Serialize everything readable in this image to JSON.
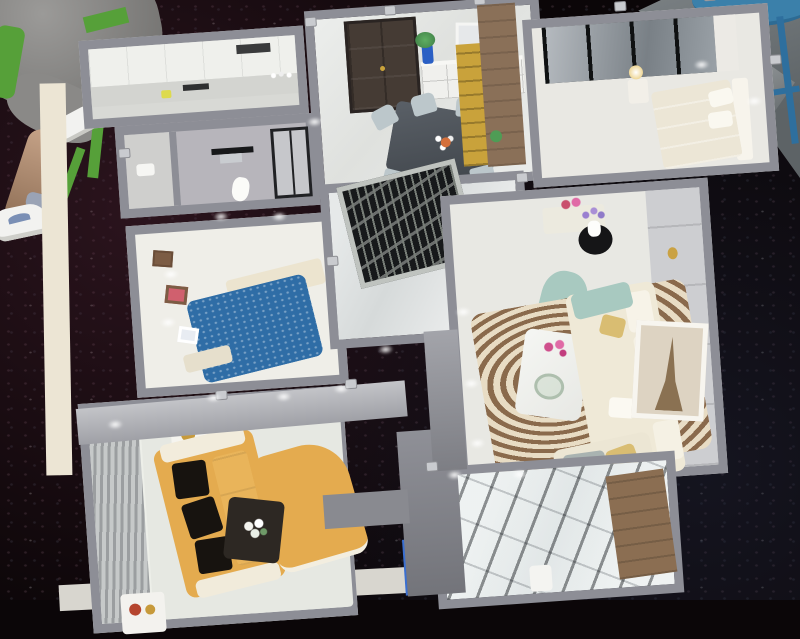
{
  "scene": {
    "type": "photograph",
    "description": "Overhead photo of a miniature apartment scale model displayed on a black sequined table; a bystander's legs and sneakers and a green stool appear top-left, a blue stool on concrete floor top-right",
    "palette": {
      "table_cloth_black": "#0b0608",
      "concrete_gray": "#6f7578",
      "model_wall_silver": "#8d8e96",
      "outer_rim_cream": "#ece5d4",
      "floor_light": "#e8e8e3",
      "floor_marble": "#dfe2e2",
      "floor_bath_gray": "#b7b5bb",
      "kitchen_cabinet_white": "#eff0ec",
      "entry_door_brown": "#453b34",
      "grille_dark": "#17191b",
      "wardrobe_dark": "#2c2e31",
      "bed_blue": "#2f6da6",
      "headboard_cream": "#ece4cf",
      "bed_master_cream": "#ece6d6",
      "sofa_gold": "#e4ab4f",
      "cushion_black": "#17130f",
      "dark_table_brown": "#2d2823",
      "sofa_cream": "#efe9d7",
      "accent_teal": "#a8c9c0",
      "cushion_gold": "#d9bd72",
      "rug_swirl_brown": "#8a6a4c",
      "rug_swirl_cream": "#e8dcc4",
      "wood_partition": "#8a7058",
      "wine_gold": "#c9a23b",
      "balcony_wood": "#8b6e52",
      "vase_blue": "#2a5fc4",
      "flower_pink": "#cf4f8c",
      "flower_purple": "#9a7fd0",
      "flower_blue": "#3a6fd0",
      "plant_green": "#4f9c55",
      "stool_blue": "#3b80aa",
      "stool_leg_blue": "#2e6f9e",
      "chair_green": "#56a039",
      "shorts_gray": "#8a8987",
      "skin_tan": "#c5a287",
      "sneaker_white": "#f2f2f0",
      "table_glass_dark": "#4a4f55",
      "chair_dining": "#bcc7cb",
      "toilet_white": "#fbfbf8"
    },
    "bystander": {
      "clothing": "gray shorts",
      "footwear": "white sneakers",
      "seat": "green stool"
    },
    "furniture_props": {
      "blue_stool": "round blue metal stool on concrete floor",
      "sequins": "sparkling dots on black cloth"
    },
    "rooms": [
      {
        "name": "kitchen",
        "floor": "light gray",
        "items": [
          "white cabinets",
          "counter with bottles",
          "dark cooktop",
          "yellow utensil"
        ]
      },
      {
        "name": "bathroom",
        "floor": "gray",
        "items": [
          "toilet",
          "black towel rack",
          "glass shower enclosure",
          "sink room"
        ]
      },
      {
        "name": "dining-room",
        "floor": "marble",
        "items": [
          "dark brown entry door",
          "cube-shelf sideboard",
          "leaning art frame",
          "blue vase with plant",
          "dark glass dining table",
          "six upholstered chairs"
        ]
      },
      {
        "name": "entry-partition",
        "items": [
          "black metal grille screen"
        ]
      },
      {
        "name": "master-bedroom",
        "floor": "light",
        "items": [
          "mirrored sliding wardrobe",
          "cream bed with pillows",
          "bedside lamp"
        ]
      },
      {
        "name": "blue-bedroom",
        "floor": "light",
        "items": [
          "sparkly blue duvet bed",
          "cream headboard",
          "wall shelves with small frames"
        ]
      },
      {
        "name": "living-room",
        "floor": "light",
        "items": [
          "brown swirl rug",
          "white marble coffee table with pink flowers",
          "cream L-shaped sofa",
          "teal accent chair",
          "black side table with purple flowers",
          "leaning Eiffel-tower art",
          "wainscot wall"
        ]
      },
      {
        "name": "family-room",
        "floor": "light",
        "items": [
          "gold sofa with black cushions",
          "gold chaise",
          "dark coffee table with white flowers",
          "white cube side tables",
          "striped TV feature wall"
        ]
      },
      {
        "name": "balcony",
        "items": [
          "glass roof grid",
          "wood cabinet",
          "blue potted flowers"
        ]
      }
    ]
  }
}
